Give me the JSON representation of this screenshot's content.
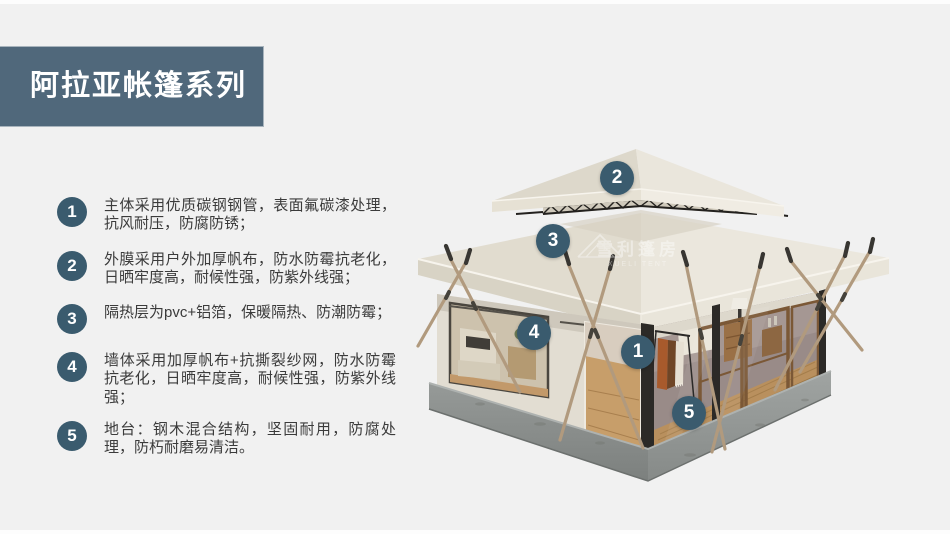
{
  "header": {
    "title": "阿拉亚帐篷系列"
  },
  "features": {
    "items": [
      {
        "number": "1",
        "text": "主体采用优质碳钢钢管，表面氟碳漆处理，抗风耐压，防腐防锈；"
      },
      {
        "number": "2",
        "text": "外膜采用户外加厚帆布，防水防霉抗老化，日晒牢度高，耐候性强，防紫外线强；"
      },
      {
        "number": "3",
        "text": "隔热层为pvc+铝箔，保暖隔热、防潮防霉；"
      },
      {
        "number": "4",
        "text": "墙体采用加厚帆布+抗撕裂纱网，防水防霉抗老化，日晒牢度高，耐候性强，防紫外线强；"
      },
      {
        "number": "5",
        "text": "地台：钢木混合结构，坚固耐用，防腐处理，防朽耐磨易清洁。"
      }
    ]
  },
  "tent": {
    "callouts": [
      {
        "number": "1"
      },
      {
        "number": "2"
      },
      {
        "number": "3"
      },
      {
        "number": "4"
      },
      {
        "number": "5"
      }
    ],
    "watermark": {
      "cn": "雪利篷房",
      "en": "XUELI TENT"
    }
  },
  "colors": {
    "accent": "#3a5b6e",
    "banner": "#50687b",
    "background": "#f1f1f1"
  }
}
